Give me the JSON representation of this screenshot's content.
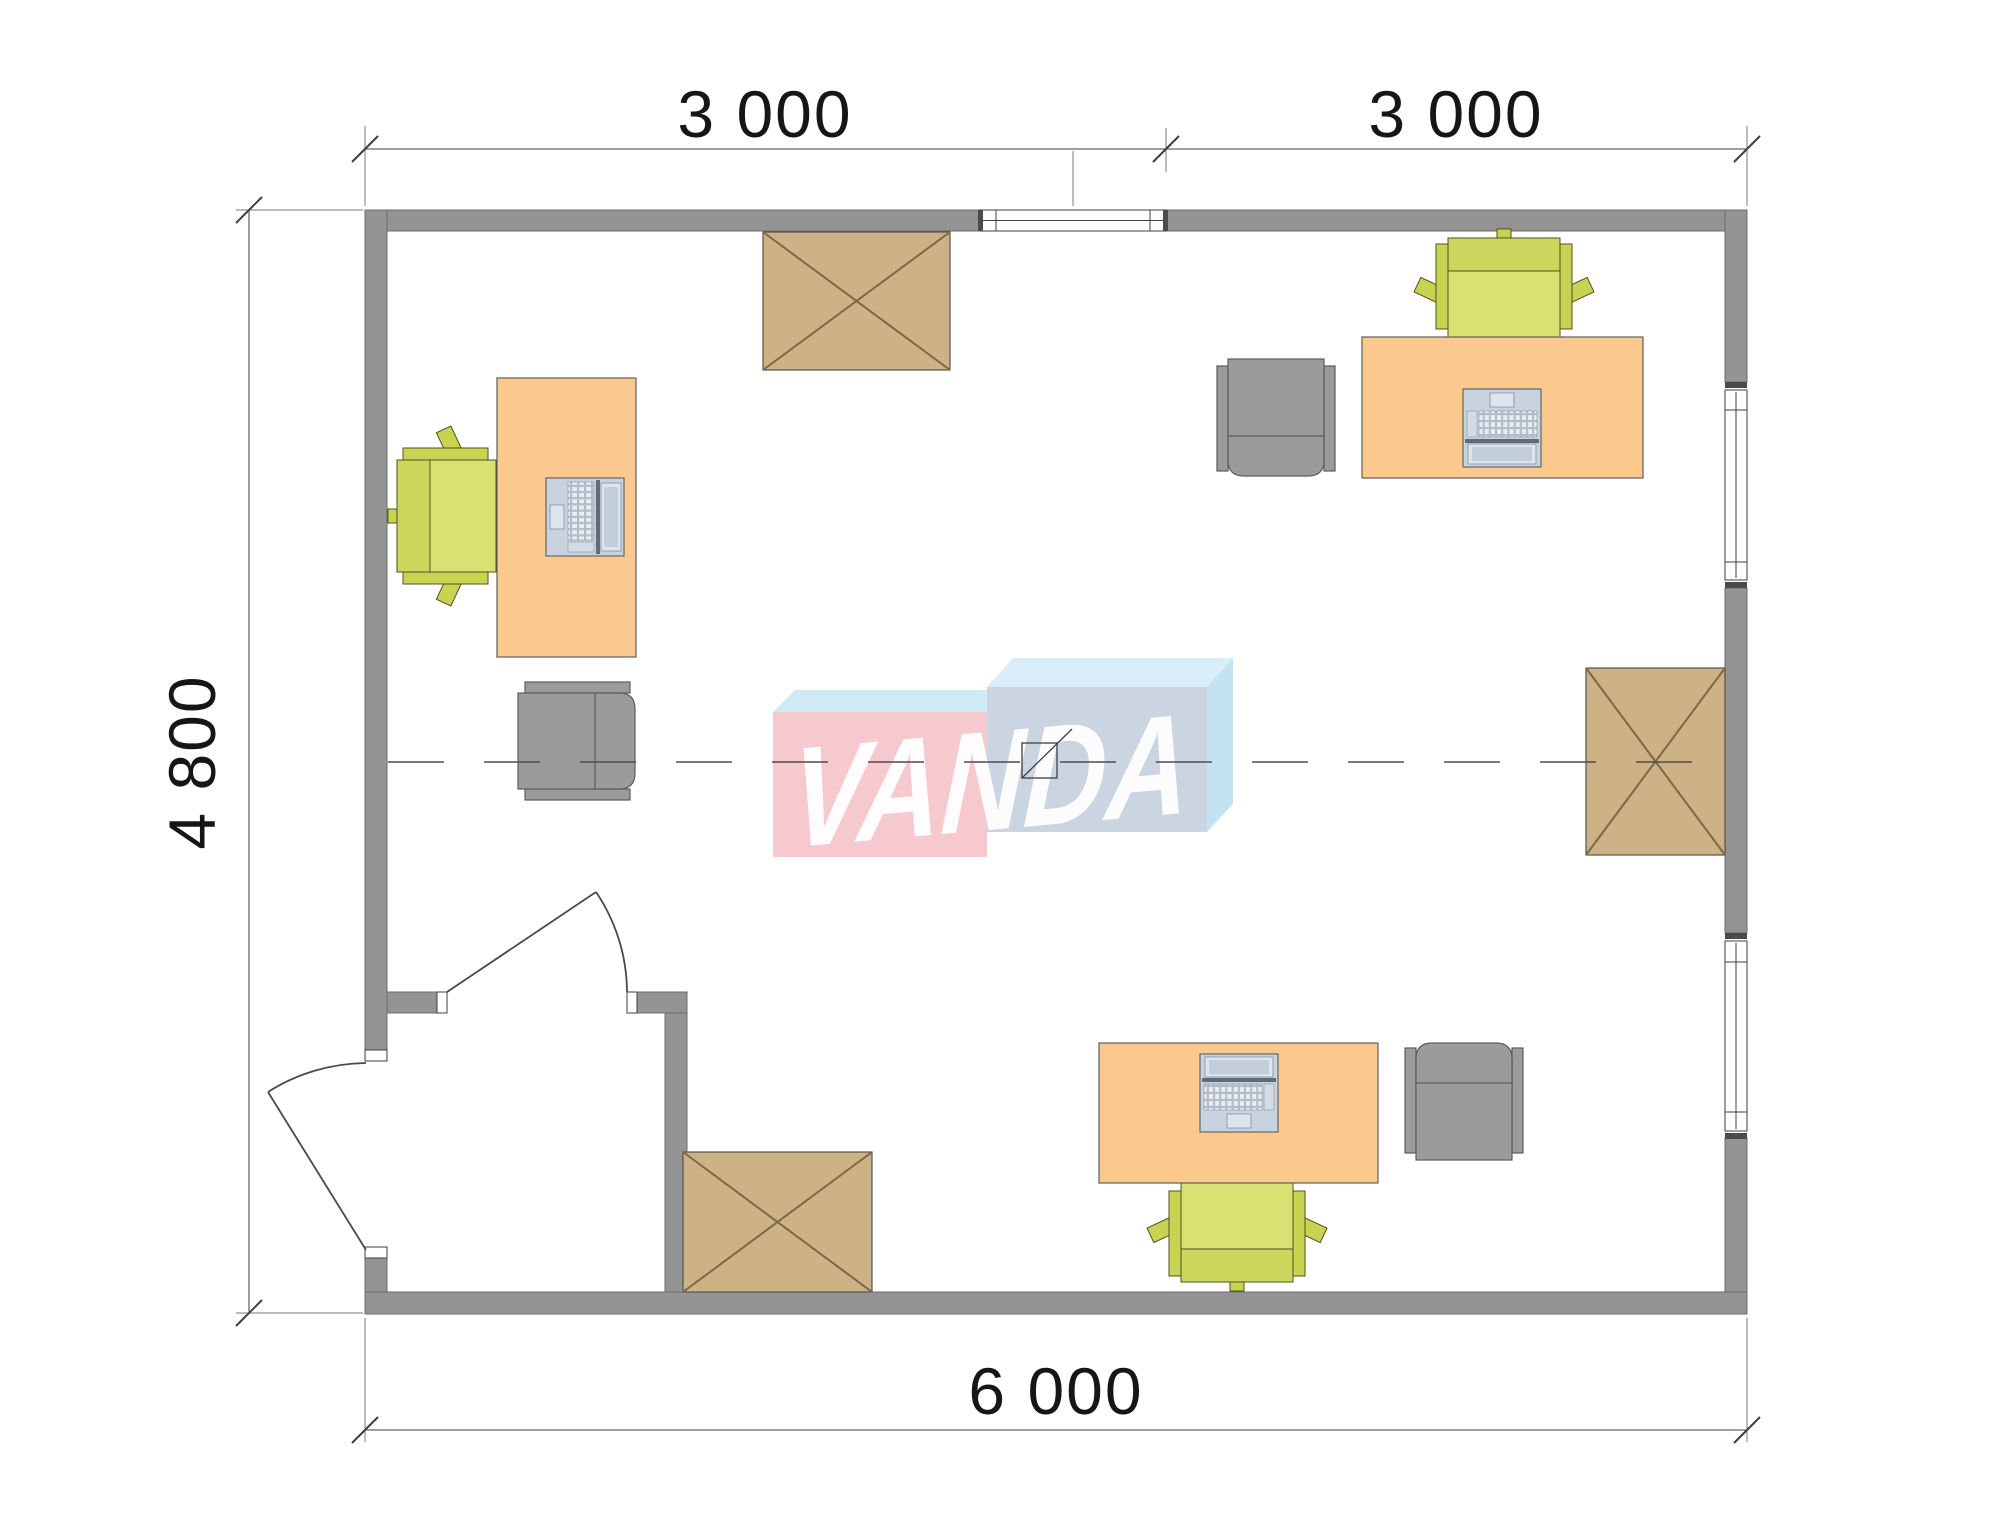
{
  "watermark": {
    "text": "VANDA"
  },
  "dimensions": {
    "top": [
      {
        "label": "3 000"
      },
      {
        "label": "3 000"
      }
    ],
    "left": {
      "label": "4 800"
    },
    "bottom": {
      "label": "6 000"
    }
  },
  "objects": {
    "desks": "orange office desks (3)",
    "laptops": "laptop icons on desks (3)",
    "task_chairs": "green swivel chairs (3)",
    "guest_chairs": "gray armchairs (3)",
    "storage_boxes": "crossed storage/void boxes (3)",
    "doors": "entrance door and vestibule door (2)",
    "windows": "windows: 1 top wall, 2 right wall",
    "centerline": "dashed module axis line",
    "module_joint_marker": "small crossed square at plan center"
  },
  "colors": {
    "wall": "#949494",
    "wall-edge": "#6b6b6b",
    "dim": "#3f3f3f",
    "desk": "#fbc98e",
    "box": "#cdb286",
    "box-line": "#7c6847",
    "chair-green": "#d8e171",
    "chair-green-dark": "#ccd65c",
    "chair-green-arm": "#c9d352",
    "chair-green-edge": "#52521f",
    "chair-gray": "#9b9b9b",
    "chair-gray-edge": "#5c5c5c",
    "logo-pink": "#f6c9cf",
    "logo-pink-top": "#cfe9f5",
    "logo-blue-front": "#cbd5e2",
    "logo-blue-top": "#d9eef8",
    "logo-blue-side": "#c3e3f3",
    "logo-text": "#ffffff"
  }
}
